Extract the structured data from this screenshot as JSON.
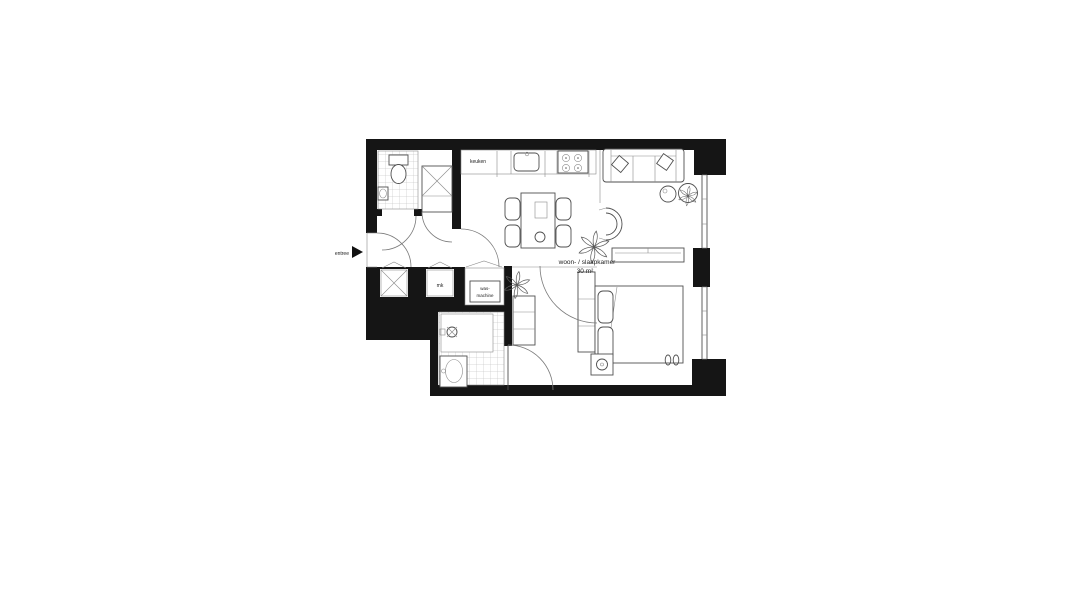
{
  "plan": {
    "labels": {
      "entrance": "entree",
      "kitchen": "keuken",
      "main_room_name": "woon- / slaapkamer",
      "main_room_area": "30 m²",
      "meter_cupboard": "mk",
      "washing_machine_line1": "was-",
      "washing_machine_line2": "machine"
    },
    "colors": {
      "wall": "#151515",
      "furniture_line": "#4f4f4f",
      "tile_line": "#b5b5b5",
      "door_arc": "#7a7a7a",
      "text": "#222222",
      "background": "#ffffff"
    }
  }
}
